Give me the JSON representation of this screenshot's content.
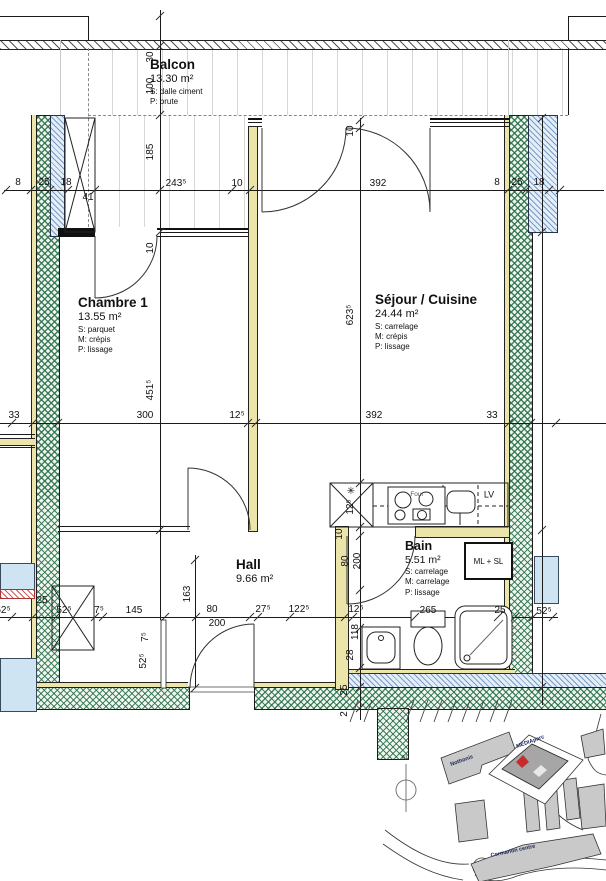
{
  "plan": {
    "balcon": {
      "name": "Balcon",
      "area": "13.30 m²",
      "l1": "S: dalle ciment",
      "l2": "P: brute"
    },
    "chambre": {
      "name": "Chambre 1",
      "area": "13.55 m²",
      "l1": "S: parquet",
      "l2": "M: crépis",
      "l3": "P: lissage"
    },
    "sejour": {
      "name": "Séjour / Cuisine",
      "area": "24.44 m²",
      "l1": "S: carrelage",
      "l2": "M: crépis",
      "l3": "P: lissage"
    },
    "hall": {
      "name": "Hall",
      "area": "9.66 m²"
    },
    "bain": {
      "name": "Bain",
      "area": "5.51 m²",
      "l1": "S: carrelage",
      "l2": "M: carrelage",
      "l3": "P: lissage"
    },
    "labels": {
      "ml_sl": "ML + SL",
      "lv": "LV",
      "four": "Four",
      "star": "✳"
    }
  },
  "dims": {
    "top": [
      "8",
      "25",
      "18",
      "41",
      "243⁵",
      "10",
      "392",
      "8",
      "25",
      "18"
    ],
    "mid": [
      "33",
      "300",
      "12⁵",
      "392",
      "33"
    ],
    "bottom": [
      "52⁵",
      "25",
      "52⁵",
      "7⁵",
      "145",
      "80",
      "200",
      "27⁵",
      "122⁵",
      "12⁵",
      "265",
      "25",
      "52⁵"
    ],
    "left": [
      "30",
      "100",
      "185",
      "10",
      "451⁵"
    ],
    "center": [
      "10",
      "623⁵",
      "12⁵",
      "10",
      "80",
      "200",
      "118",
      "28",
      "25",
      "2"
    ],
    "hall": [
      "163",
      "7⁵",
      "52⁵"
    ]
  },
  "site": {
    "north": "N",
    "b1": "Nothonis",
    "b2": "MEDIAparc",
    "b3": "Cormanon centre"
  }
}
